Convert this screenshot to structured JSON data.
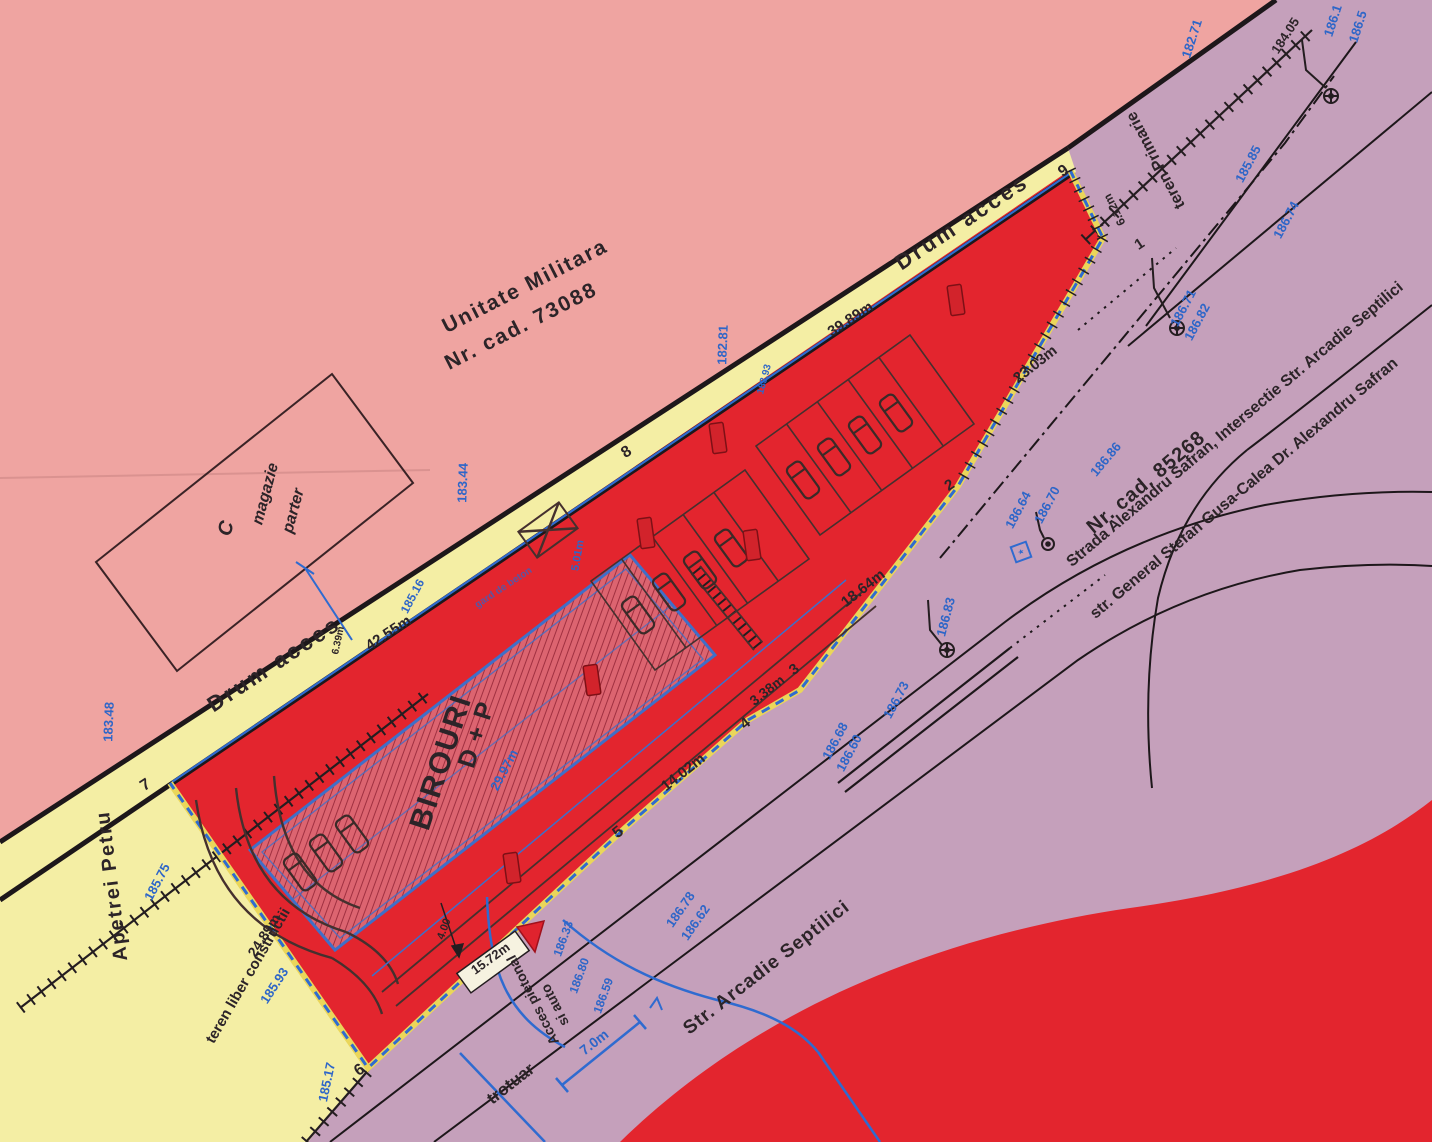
{
  "document_type": "cadastral site plan (scanned)",
  "colors": {
    "pink": "#efa4a1",
    "yellow": "#f4eea4",
    "red": "#e3252e",
    "purple": "#c5a0bb",
    "b": "#2e66c8",
    "d": "#2c2428",
    "road_line": "#1d171a",
    "building_fill": "#dc6470",
    "building_hatch": "#a03040",
    "building_border": "#3f6fc8",
    "boundary_dash_blue": "#2f6bd0",
    "boundary_backing": "#ead65a",
    "stamp_red": "#d2232b"
  },
  "map_labels": [
    {
      "n": "label-unitate-militara",
      "t": "Unitate Militara",
      "x": 528,
      "y": 292,
      "r": -27,
      "s": 21,
      "c": "d",
      "w": 1,
      "ls": 2
    },
    {
      "n": "label-nr-cad-73088",
      "t": "Nr. cad. 73088",
      "x": 524,
      "y": 332,
      "r": -27,
      "s": 21,
      "c": "d",
      "w": 1,
      "ls": 2
    },
    {
      "n": "label-building-c",
      "t": "C",
      "x": 232,
      "y": 530,
      "r": -75,
      "s": 20,
      "c": "d",
      "f": 1
    },
    {
      "n": "label-magazie",
      "t": "magazie",
      "x": 270,
      "y": 495,
      "r": -75,
      "s": 16,
      "c": "d",
      "f": 1
    },
    {
      "n": "label-parter",
      "t": "parter",
      "x": 298,
      "y": 512,
      "r": -75,
      "s": 16,
      "c": "d",
      "f": 1
    },
    {
      "n": "label-drum-acces-left",
      "t": "Drum acces",
      "x": 278,
      "y": 670,
      "r": -33.5,
      "s": 22,
      "c": "d",
      "w": 1,
      "ls": 3
    },
    {
      "n": "label-drum-acces-right",
      "t": "Drum acces",
      "x": 966,
      "y": 228,
      "r": -33.5,
      "s": 22,
      "c": "d",
      "w": 1,
      "ls": 3
    },
    {
      "n": "dim-42-55m",
      "t": "42.55m",
      "x": 391,
      "y": 637,
      "r": -33.5,
      "s": 15,
      "c": "d",
      "w": 1
    },
    {
      "n": "dim-39-89m",
      "t": "39.89m",
      "x": 853,
      "y": 323,
      "r": -33.5,
      "s": 15,
      "c": "d",
      "w": 1
    },
    {
      "n": "elev-183-48",
      "t": "183.48",
      "x": 113,
      "y": 722,
      "r": -88,
      "s": 13,
      "c": "b"
    },
    {
      "n": "elev-183-44",
      "t": "183.44",
      "x": 467,
      "y": 483,
      "r": -88,
      "s": 13,
      "c": "b"
    },
    {
      "n": "elev-185-16",
      "t": "185.16",
      "x": 416,
      "y": 598,
      "r": -62,
      "s": 12,
      "c": "b"
    },
    {
      "n": "dim-6-39m",
      "t": "6.39m",
      "x": 341,
      "y": 641,
      "r": -78,
      "s": 10,
      "c": "d"
    },
    {
      "n": "elev-182-81",
      "t": "182.81",
      "x": 727,
      "y": 345,
      "r": -88,
      "s": 13,
      "c": "b"
    },
    {
      "n": "elev-183-93",
      "t": "183.93",
      "x": 767,
      "y": 380,
      "r": -75,
      "s": 10,
      "c": "b"
    },
    {
      "n": "label-gard-de-beton",
      "t": "gard de beton",
      "x": 505,
      "y": 590,
      "r": -33.5,
      "s": 10,
      "c": "b",
      "o": 0.75
    },
    {
      "n": "label-birouri",
      "t": "BIROURI",
      "x": 450,
      "y": 765,
      "r": -72,
      "s": 30,
      "c": "d",
      "w": 1,
      "ls": 2
    },
    {
      "n": "label-d-plus-p",
      "t": "D + P",
      "x": 484,
      "y": 737,
      "r": -72,
      "s": 25,
      "c": "d",
      "w": 1,
      "ls": 1
    },
    {
      "n": "dim-29-97m",
      "t": "29.97m",
      "x": 508,
      "y": 772,
      "r": -62,
      "s": 13,
      "c": "b"
    },
    {
      "n": "dim-5-01m",
      "t": "5.01m",
      "x": 581,
      "y": 556,
      "r": -80,
      "s": 11,
      "c": "b"
    },
    {
      "n": "marker-7",
      "t": "7",
      "x": 148,
      "y": 789,
      "r": -33,
      "s": 16,
      "c": "d",
      "w": 1
    },
    {
      "n": "marker-8",
      "t": "8",
      "x": 629,
      "y": 456,
      "r": -33,
      "s": 16,
      "c": "d",
      "w": 1
    },
    {
      "n": "marker-9",
      "t": "9",
      "x": 1066,
      "y": 175,
      "r": -33,
      "s": 16,
      "c": "d",
      "w": 1
    },
    {
      "n": "marker-1",
      "t": "1",
      "x": 1142,
      "y": 248,
      "r": -33,
      "s": 15,
      "c": "d",
      "w": 1
    },
    {
      "n": "marker-2",
      "t": "2",
      "x": 952,
      "y": 489,
      "r": -33,
      "s": 15,
      "c": "d",
      "w": 1
    },
    {
      "n": "marker-3",
      "t": "3",
      "x": 797,
      "y": 673,
      "r": -38,
      "s": 15,
      "c": "d",
      "w": 1
    },
    {
      "n": "marker-4",
      "t": "4",
      "x": 748,
      "y": 727,
      "r": -38,
      "s": 15,
      "c": "d",
      "w": 1
    },
    {
      "n": "marker-5",
      "t": "5",
      "x": 621,
      "y": 836,
      "r": -38,
      "s": 16,
      "c": "d",
      "w": 1
    },
    {
      "n": "marker-6",
      "t": "6",
      "x": 362,
      "y": 1074,
      "r": -33,
      "s": 16,
      "c": "d",
      "w": 1
    },
    {
      "n": "dim-6-12m",
      "t": "6.12m",
      "x": 1118,
      "y": 208,
      "r": -117,
      "s": 12,
      "c": "d",
      "w": 1
    },
    {
      "n": "dim-23-03m",
      "t": "23.03m",
      "x": 1038,
      "y": 368,
      "r": -38,
      "s": 15,
      "c": "d",
      "w": 1
    },
    {
      "n": "dim-18-64m",
      "t": "18.64m",
      "x": 866,
      "y": 592,
      "r": -38,
      "s": 15,
      "c": "d",
      "w": 1
    },
    {
      "n": "dim-3-38m",
      "t": "3.38m",
      "x": 770,
      "y": 694,
      "r": -38,
      "s": 14,
      "c": "d",
      "w": 1
    },
    {
      "n": "dim-14-02m",
      "t": "14.02m",
      "x": 686,
      "y": 776,
      "r": -38,
      "s": 15,
      "c": "d",
      "w": 1
    },
    {
      "n": "dim-24-89m",
      "t": "24.89m",
      "x": 268,
      "y": 938,
      "r": -57,
      "s": 14,
      "c": "d",
      "w": 1
    },
    {
      "n": "elev-185-17",
      "t": "185.17",
      "x": 331,
      "y": 1083,
      "r": -78,
      "s": 13,
      "c": "b"
    },
    {
      "n": "elev-185-93",
      "t": "185.93",
      "x": 278,
      "y": 988,
      "r": -57,
      "s": 13,
      "c": "b"
    },
    {
      "n": "elev-185-75",
      "t": "185.75",
      "x": 161,
      "y": 884,
      "r": -62,
      "s": 13,
      "c": "b"
    },
    {
      "n": "label-teren-primarie",
      "t": "teren Primarie",
      "x": 1160,
      "y": 158,
      "r": -118,
      "s": 16,
      "c": "d"
    },
    {
      "n": "elev-182-71",
      "t": "182.71",
      "x": 1196,
      "y": 40,
      "r": -72,
      "s": 13,
      "c": "b"
    },
    {
      "n": "elev-184-05",
      "t": "184.05",
      "x": 1289,
      "y": 38,
      "r": -57,
      "s": 13,
      "c": "d"
    },
    {
      "n": "elev-186-1-partial",
      "t": "186.1",
      "x": 1337,
      "y": 22,
      "r": -72,
      "s": 13,
      "c": "b"
    },
    {
      "n": "elev-186-5-partial",
      "t": "186.5",
      "x": 1362,
      "y": 28,
      "r": -72,
      "s": 13,
      "c": "b"
    },
    {
      "n": "elev-185-85",
      "t": "185.85",
      "x": 1252,
      "y": 166,
      "r": -62,
      "s": 13,
      "c": "b"
    },
    {
      "n": "elev-186-74",
      "t": "186.74",
      "x": 1290,
      "y": 222,
      "r": -62,
      "s": 13,
      "c": "b"
    },
    {
      "n": "elev-186-71",
      "t": "186.71",
      "x": 1187,
      "y": 310,
      "r": -62,
      "s": 13,
      "c": "b"
    },
    {
      "n": "elev-186-82",
      "t": "186.82",
      "x": 1201,
      "y": 324,
      "r": -62,
      "s": 13,
      "c": "b"
    },
    {
      "n": "label-nr-cad-85268",
      "t": "Nr. cad. 85268",
      "x": 1150,
      "y": 487,
      "r": -40,
      "s": 20,
      "c": "d",
      "w": 1,
      "ls": 1
    },
    {
      "n": "label-strada-safran-intersectie",
      "t": "Strada Alexandru Safran, Intersectie Str. Arcadie Septilici",
      "x": 1238,
      "y": 428,
      "r": -40,
      "s": 16,
      "c": "d",
      "w": 1
    },
    {
      "n": "label-str-general-gusa",
      "t": "str. General Stefan Gusa-Calea Dr. Alexandru Safran",
      "x": 1247,
      "y": 492,
      "r": -40,
      "s": 16,
      "c": "d",
      "w": 1
    },
    {
      "n": "elev-186-64",
      "t": "186.64",
      "x": 1022,
      "y": 512,
      "r": -62,
      "s": 13,
      "c": "b"
    },
    {
      "n": "elev-186-70",
      "t": "186.70",
      "x": 1051,
      "y": 507,
      "r": -62,
      "s": 13,
      "c": "b"
    },
    {
      "n": "elev-186-86",
      "t": "186.86",
      "x": 1109,
      "y": 462,
      "r": -50,
      "s": 13,
      "c": "b"
    },
    {
      "n": "elev-186-83",
      "t": "186.83",
      "x": 950,
      "y": 618,
      "r": -75,
      "s": 13,
      "c": "b"
    },
    {
      "n": "elev-186-73",
      "t": "186.73",
      "x": 900,
      "y": 702,
      "r": -62,
      "s": 13,
      "c": "b"
    },
    {
      "n": "elev-186-68",
      "t": "186.68",
      "x": 839,
      "y": 743,
      "r": -62,
      "s": 13,
      "c": "b"
    },
    {
      "n": "elev-186-60",
      "t": "186.60",
      "x": 853,
      "y": 755,
      "r": -62,
      "s": 13,
      "c": "b"
    },
    {
      "n": "label-str-arcadie-septilici",
      "t": "Str. Arcadie Septilici",
      "x": 770,
      "y": 972,
      "r": -38,
      "s": 19,
      "c": "d",
      "w": 1,
      "ls": 1
    },
    {
      "n": "label-trotuar",
      "t": "trotuar",
      "x": 514,
      "y": 1088,
      "r": -38,
      "s": 17,
      "c": "d",
      "w": 1
    },
    {
      "n": "label-acces-pietonal",
      "t": "Acces pietonal",
      "x": 537,
      "y": 998,
      "r": -117,
      "s": 14,
      "c": "d",
      "w": 1
    },
    {
      "n": "label-si-auto",
      "t": "si auto",
      "x": 559,
      "y": 1003,
      "r": -117,
      "s": 14,
      "c": "d",
      "w": 1
    },
    {
      "n": "dim-7-0m",
      "t": "7.0m",
      "x": 597,
      "y": 1046,
      "r": -38,
      "s": 14,
      "c": "b",
      "w": 1
    },
    {
      "n": "elev-186-78",
      "t": "186.78",
      "x": 684,
      "y": 912,
      "r": -55,
      "s": 13,
      "c": "b"
    },
    {
      "n": "elev-186-62",
      "t": "186.62",
      "x": 699,
      "y": 925,
      "r": -55,
      "s": 13,
      "c": "b"
    },
    {
      "n": "elev-186-80",
      "t": "186.80",
      "x": 583,
      "y": 977,
      "r": -70,
      "s": 12,
      "c": "b"
    },
    {
      "n": "elev-186-59",
      "t": "186.59",
      "x": 607,
      "y": 997,
      "r": -70,
      "s": 12,
      "c": "b"
    },
    {
      "n": "elev-186-33",
      "t": "186.33",
      "x": 567,
      "y": 940,
      "r": -70,
      "s": 12,
      "c": "b"
    },
    {
      "n": "dim-15-72m",
      "t": "15.72m",
      "x": 493,
      "y": 962,
      "r": -36,
      "s": 13,
      "c": "d",
      "w": 1
    },
    {
      "n": "dim-4-00",
      "t": "4.00",
      "x": 447,
      "y": 930,
      "r": -70,
      "s": 11,
      "c": "d"
    },
    {
      "n": "label-apetrei-petru",
      "t": "Apetrei Petru",
      "x": 118,
      "y": 885,
      "r": -97,
      "s": 20,
      "c": "d",
      "w": 1,
      "ls": 2
    },
    {
      "n": "label-teren-liber-constructii",
      "t": "teren liber constructii",
      "x": 252,
      "y": 978,
      "r": -60,
      "s": 15,
      "c": "d"
    }
  ]
}
